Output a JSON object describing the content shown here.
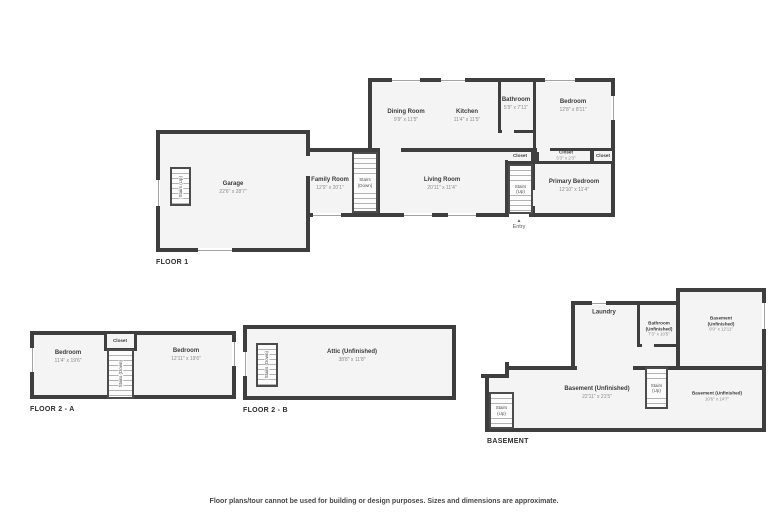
{
  "app": {
    "wall_color": "#3e3e3e",
    "room_fill": "#f4f4f4",
    "disclaimer": "Floor plans/tour cannot be used for building or design purposes. Sizes and dimensions are approximate."
  },
  "floor1": {
    "label": "FLOOR 1",
    "garage": {
      "name": "Garage",
      "dims": "22'6\" x 28'7\""
    },
    "garage_stairs": {
      "name": "Stairs (Up)"
    },
    "family_room": {
      "name": "Family Room",
      "dims": "12'9\" x 20'1\""
    },
    "stairs_down": {
      "name": "Stairs (Down)"
    },
    "living_room": {
      "name": "Living Room",
      "dims": "20'11\" x 11'4\""
    },
    "dining_room": {
      "name": "Dining Room",
      "dims": "9'9\" x 11'5\""
    },
    "kitchen": {
      "name": "Kitchen",
      "dims": "11'4\" x 11'5\""
    },
    "bathroom": {
      "name": "Bathroom",
      "dims": "5'9\" x 7'11\""
    },
    "bedroom": {
      "name": "Bedroom",
      "dims": "12'8\" x 8'11\""
    },
    "closet_main": {
      "name": "Closet",
      "dims": "5'3\" x 2'3\""
    },
    "closet_right": {
      "name": "Closet"
    },
    "closet_hall": {
      "name": "Closet"
    },
    "stairs_up": {
      "name": "Stairs (Up)"
    },
    "primary_bedroom": {
      "name": "Primary Bedroom",
      "dims": "12'10\" x 11'4\""
    },
    "entry": {
      "name": "Entry",
      "icon": "▲"
    }
  },
  "floor2a": {
    "label": "FLOOR 2 - A",
    "bedroom_left": {
      "name": "Bedroom",
      "dims": "11'4\" x 19'6\""
    },
    "closet": {
      "name": "Closet"
    },
    "stairs_down": {
      "name": "Stairs (Down)"
    },
    "bedroom_right": {
      "name": "Bedroom",
      "dims": "12'11\" x 19'6\""
    }
  },
  "floor2b": {
    "label": "FLOOR 2 - B",
    "stairs_down": {
      "name": "Stairs (Down)"
    },
    "attic": {
      "name": "Attic (Unfinished)",
      "dims": "38'8\" x 11'8\""
    }
  },
  "basement": {
    "label": "BASEMENT",
    "laundry": {
      "name": "Laundry"
    },
    "bathroom": {
      "name": "Bathroom (Unfinished)",
      "dims": "7'3\" x 10'5\""
    },
    "room_ne": {
      "name": "Basement (Unfinished)",
      "dims": "9'9\" x 12'11\""
    },
    "room_main": {
      "name": "Basement (Unfinished)",
      "dims": "22'11\" x 21'5\""
    },
    "stairs_mid": {
      "name": "Stairs (Up)"
    },
    "room_se": {
      "name": "Basement (Unfinished)",
      "dims": "10'6\" x 14'7\""
    },
    "stairs_left": {
      "name": "Stairs (Up)"
    }
  }
}
